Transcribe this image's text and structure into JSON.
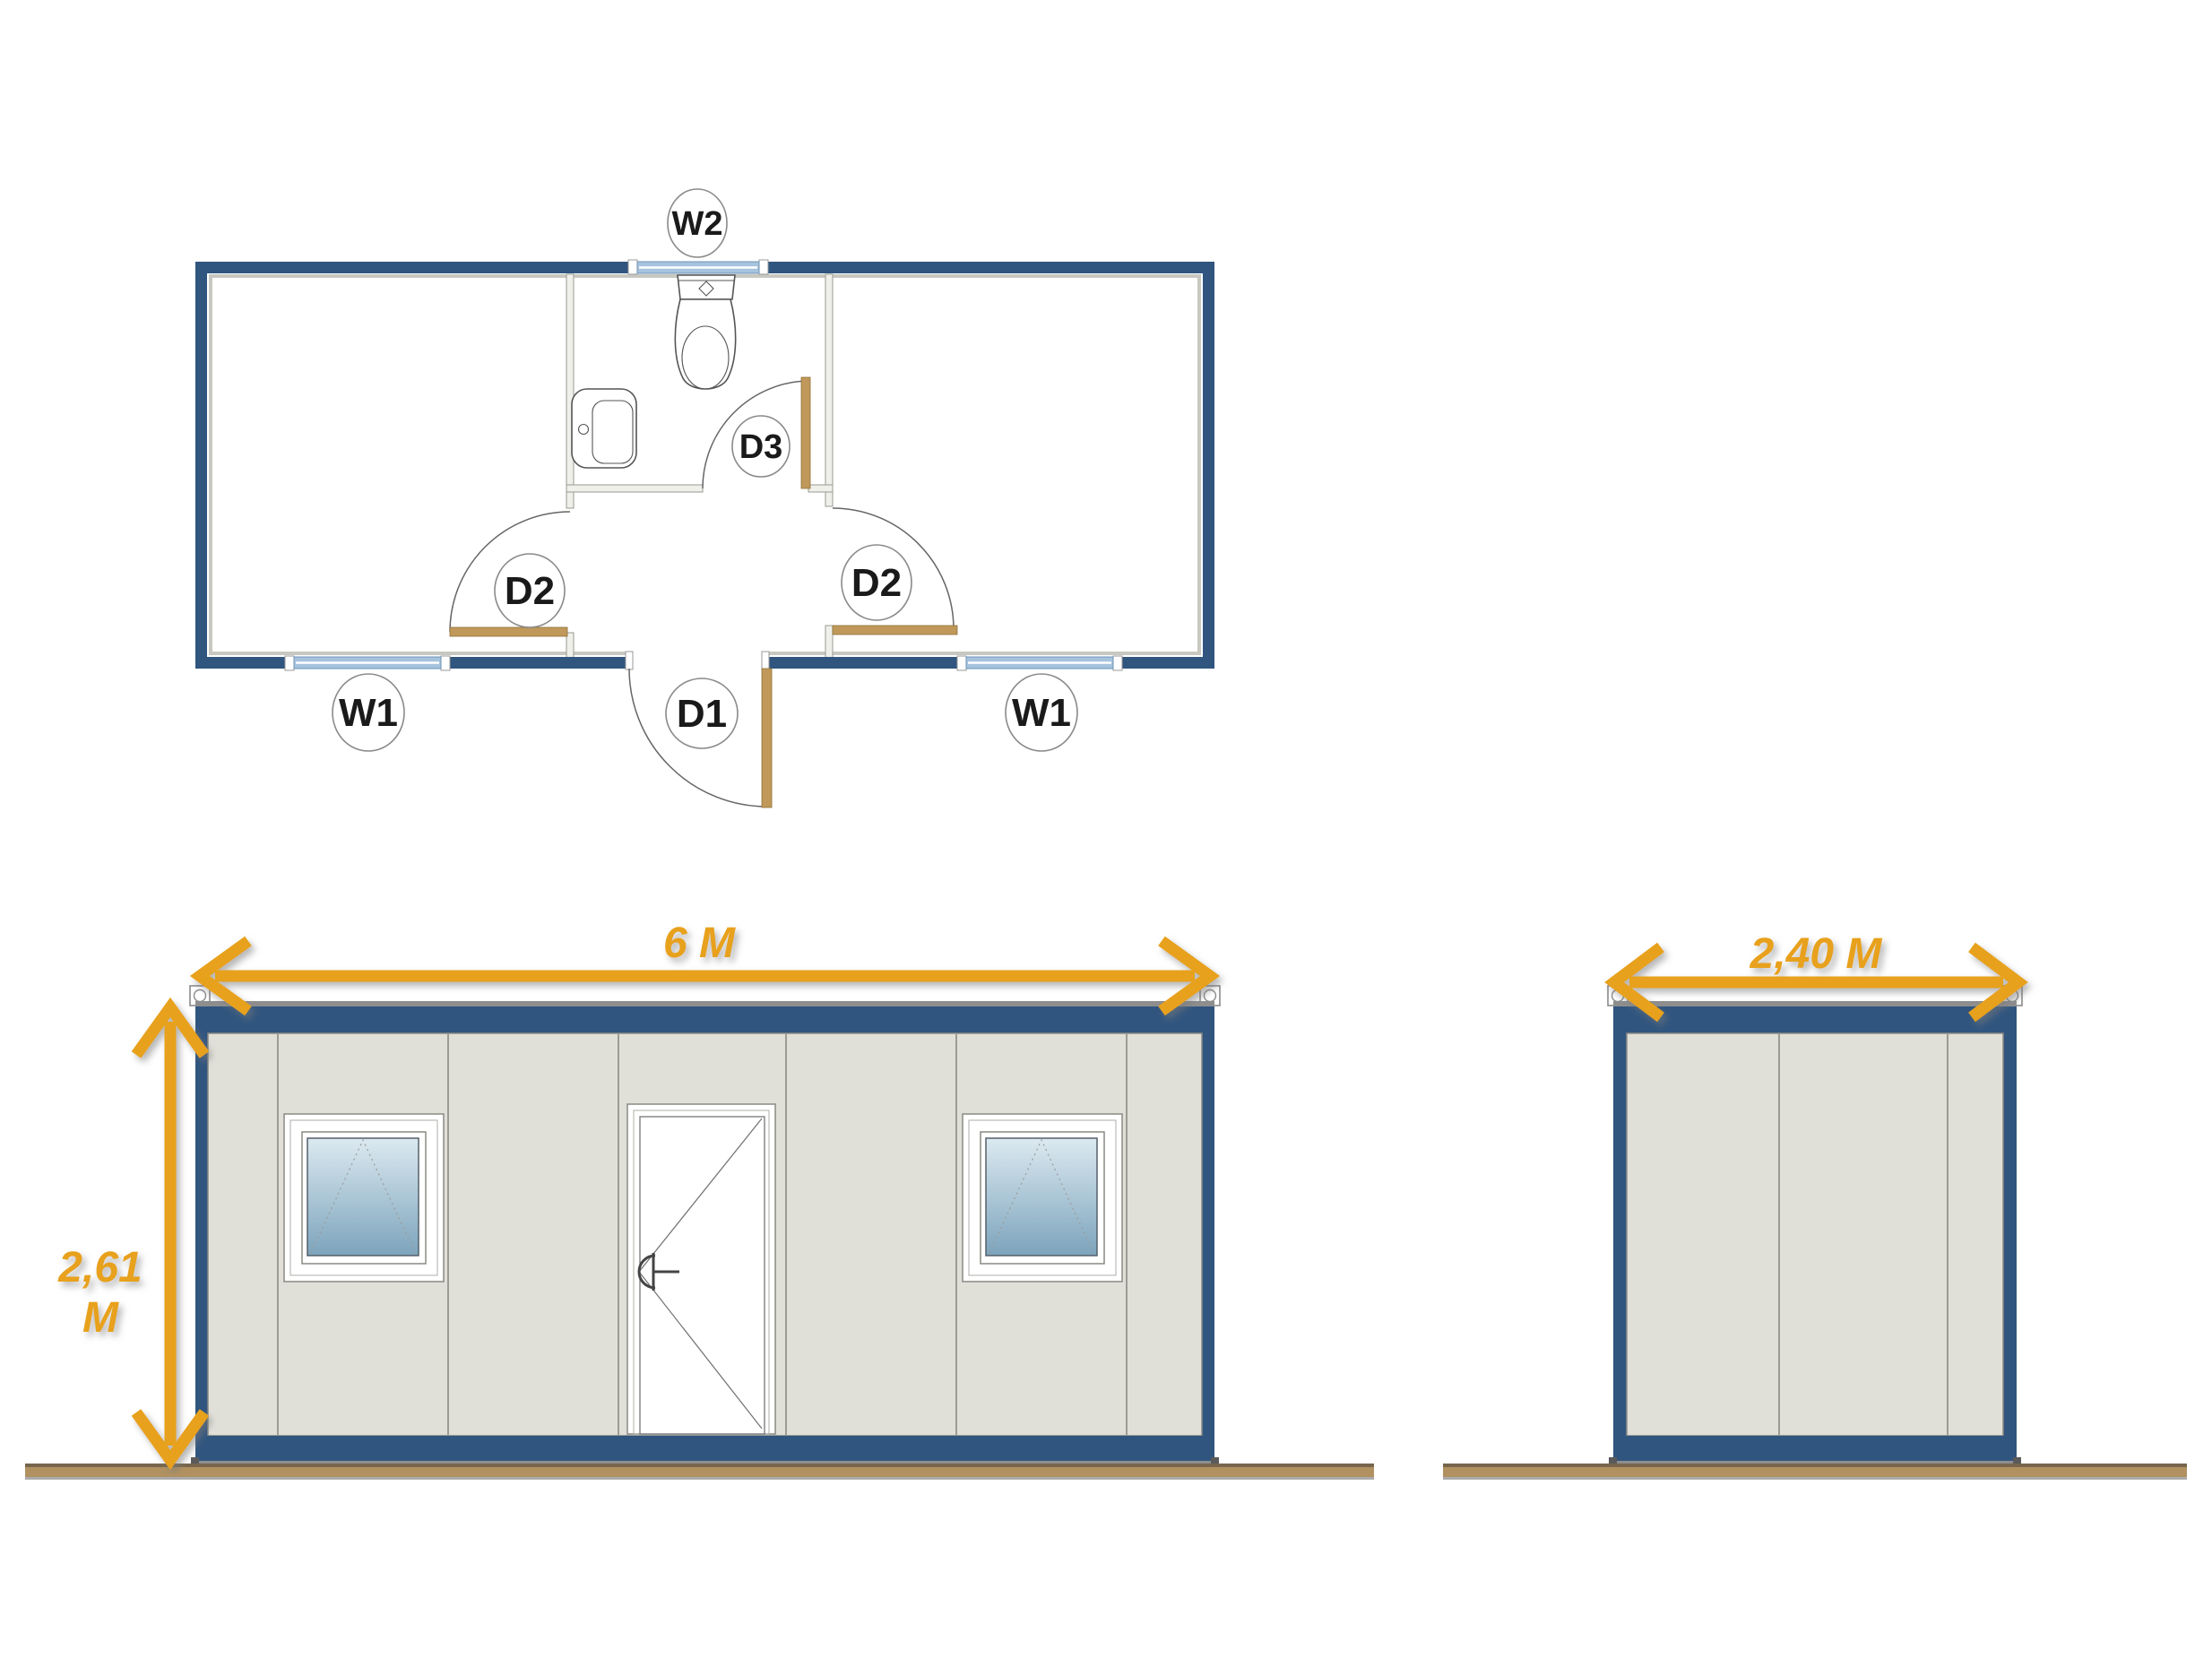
{
  "colors": {
    "container_blue": "#30557F",
    "panel_gray": "#E0E0D8",
    "panel_seam": "#9C9C94",
    "outline_gray": "#8A8A84",
    "dimension_orange": "#E8A11E",
    "ground_brown": "#B19160",
    "ground_edge": "#77664C",
    "door_panel_tan": "#C0995A",
    "plan_window_blue": "#A6C3DE",
    "glass_top": "#DCE9F0",
    "glass_bottom": "#7CA4BC"
  },
  "floor_plan": {
    "labels": {
      "window_top": "W2",
      "window_left": "W1",
      "window_right": "W1",
      "main_door": "D1",
      "room_door_left": "D2",
      "room_door_right": "D2",
      "bathroom_door": "D3"
    },
    "fixtures": {
      "toilet": "toilet-plan-symbol",
      "sink": "sink-plan-symbol"
    }
  },
  "front_elevation": {
    "width_label": "6 M",
    "height_label": [
      "2,61",
      "M"
    ]
  },
  "side_elevation": {
    "width_label": "2,40 M"
  }
}
